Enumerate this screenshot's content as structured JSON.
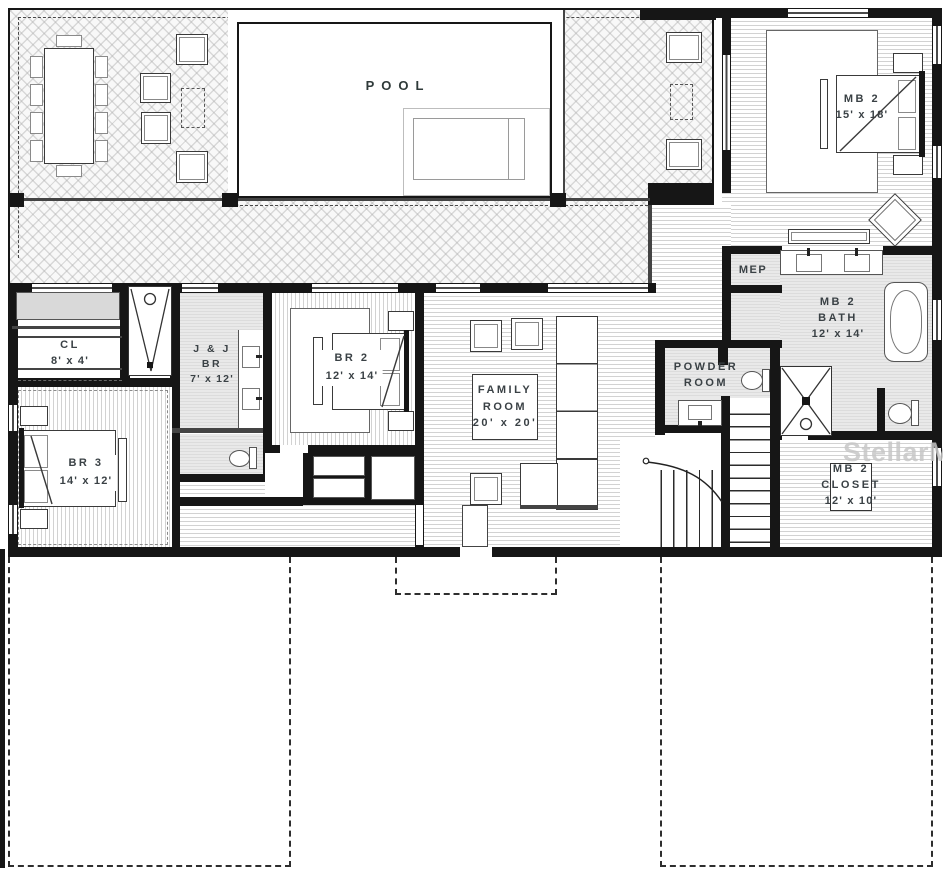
{
  "colors": {
    "wall": "#161616",
    "label_text": "#3a4145",
    "watermark_text": "#c7c7c7",
    "floor_gray": "#e4e4e4"
  },
  "watermark": {
    "text": "StellarMLS"
  },
  "rooms": {
    "pool": {
      "label": "POOL"
    },
    "mb2": {
      "line1": "MB 2",
      "line2": "15' x 18'"
    },
    "mep": {
      "line1": "MEP"
    },
    "mb2_bath": {
      "line1": "MB 2",
      "line2": "BATH",
      "line3": "12' x 14'"
    },
    "powder": {
      "line1": "POWDER",
      "line2": "ROOM"
    },
    "mb2_closet": {
      "line1": "MB 2",
      "line2": "CLOSET",
      "line3": "12' x 10'"
    },
    "family": {
      "line1": "FAMILY",
      "line2": "ROOM",
      "line3": "20' x 20'"
    },
    "br2": {
      "line1": "BR 2",
      "line2": "12' x 14'"
    },
    "jj": {
      "line1": "J & J",
      "line2": "BR",
      "line3": "7' x 12'"
    },
    "cl": {
      "line1": "CL",
      "line2": "8' x 4'"
    },
    "br3": {
      "line1": "BR 3",
      "line2": "14' x 12'"
    }
  }
}
